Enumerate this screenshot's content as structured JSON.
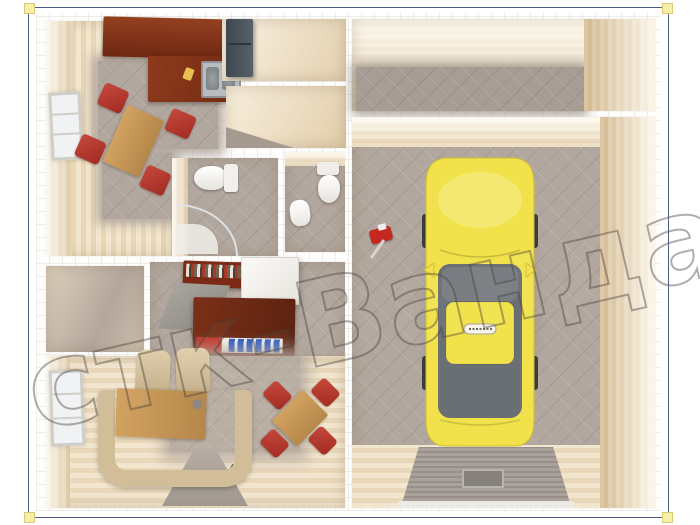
{
  "meta": {
    "description": "3D top-down architectural render of a modular home (kitchen-dining, hallway, two bathrooms, office, closet, living room) with attached garage containing a yellow car",
    "canvas": {
      "width": 700,
      "height": 525
    }
  },
  "watermark": {
    "text": "стк-Ванда"
  },
  "palette": {
    "selection_border": "#505c85",
    "selection_handle": "#f6f0a6",
    "wall_white": "#ffffff",
    "wall_face_beige": "#eddcbe",
    "floor_wood_light": "#f2e4cb",
    "floor_tile_gray": "#b0a59c",
    "kitchen_cabinet_brown": "#7c2d16",
    "desk_mahogany": "#6b2a14",
    "chair_red": "#b5352c",
    "sofa_beige": "#d2bd99",
    "table_wood": "#c89a58",
    "car_yellow": "#f0e14a",
    "car_glass_gray": "#676c71",
    "fridge_gray": "#47505a",
    "ramp_gray": "#9c948c"
  },
  "scene": {
    "left_unit_rooms": [
      "kitchen-dining",
      "pantry-with-fridge",
      "hallway",
      "bathroom-1",
      "bathroom-2",
      "office",
      "closet",
      "living-room"
    ],
    "right_unit_rooms": [
      "corridor",
      "garage"
    ],
    "vehicle": "yellow-car"
  }
}
